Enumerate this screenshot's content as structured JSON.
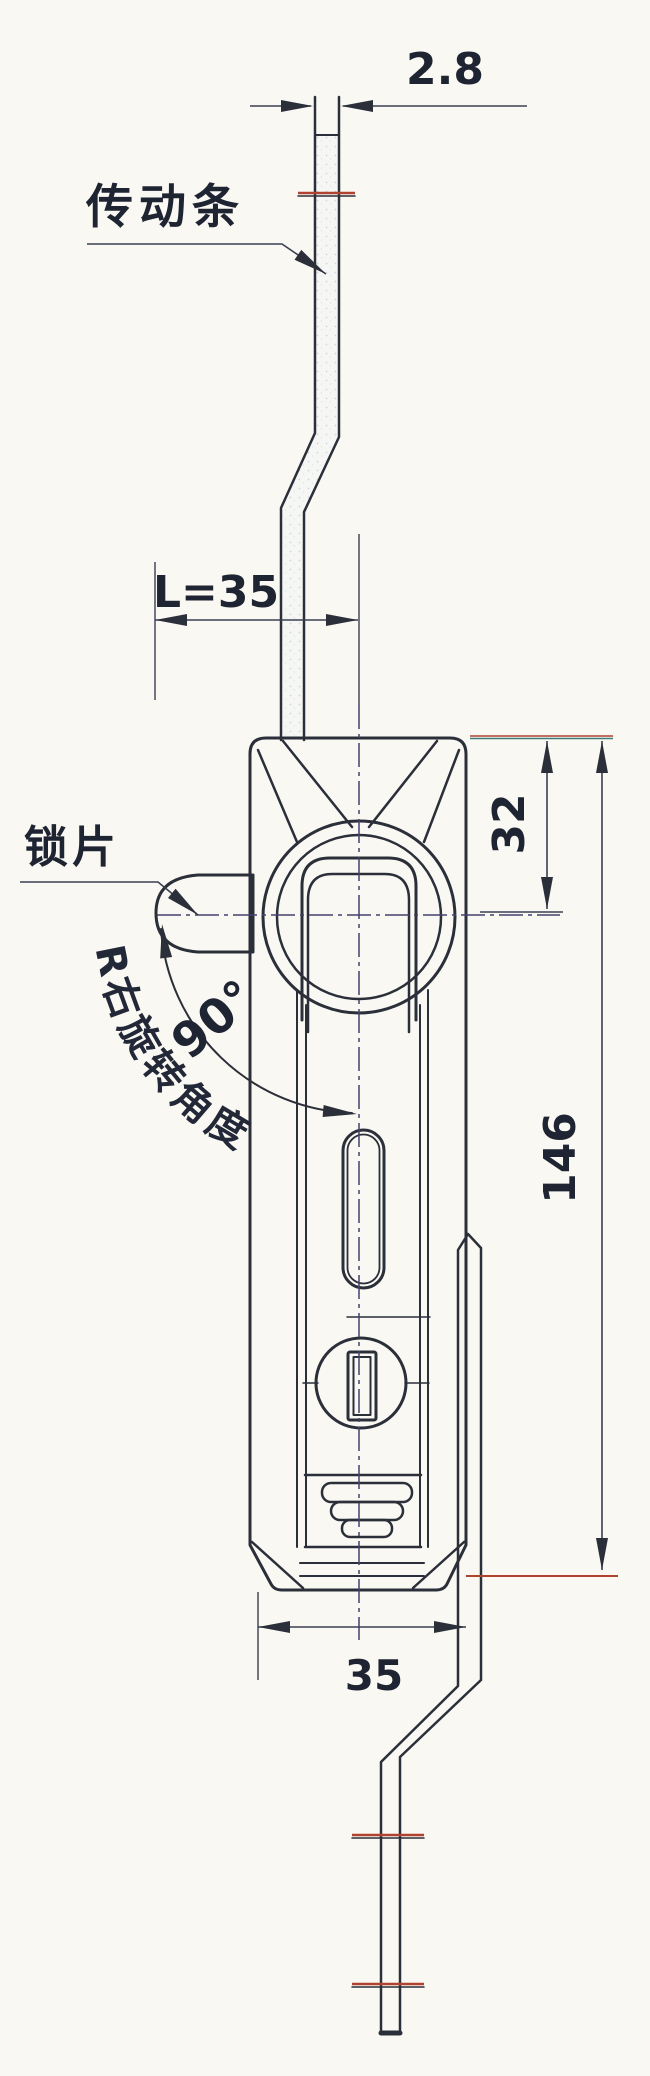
{
  "drawing": {
    "title": "rod-control-lock-technical-drawing",
    "labels": {
      "part_top": "传动条",
      "part_side": "锁片",
      "rotation_note": "R右旋转角度",
      "angle": "90°"
    },
    "dimensions": {
      "bar_thickness": "2.8",
      "tongue_length": "L=35",
      "head_height": "32",
      "body_length": "146",
      "body_width": "35"
    },
    "colors": {
      "paper": "#faf8f2",
      "ink": "#2b2f3a",
      "centerline": "#44406e",
      "accent_red": "#b0432f",
      "accent_teal": "#3f7f78",
      "part_fill": "#f2f5f4"
    }
  }
}
